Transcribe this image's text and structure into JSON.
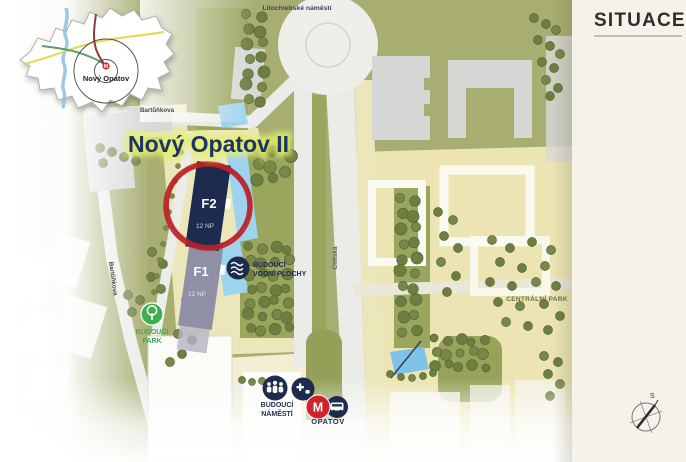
{
  "panel": {
    "title": "SITUACE"
  },
  "inset": {
    "place_label": "Nový Opatov",
    "metro_symbol": "M"
  },
  "map": {
    "project_title": "Nový Opatov II",
    "streets": {
      "litochlebske_namesti": "Litochlebské náměstí",
      "bartunkova_top": "Bartůňkova",
      "bartunkova_west": "Bartůňkova",
      "chilska": "Chilská"
    },
    "buildings": {
      "f2": {
        "label": "F2",
        "floors": "12 NP"
      },
      "f1": {
        "label": "F1",
        "floors": "12 NP"
      }
    },
    "poi": {
      "future_water": {
        "line1": "BUDOUCÍ",
        "line2": "VODNÍ PLOCHY"
      },
      "future_park": {
        "line1": "BUDOUCÍ",
        "line2": "PARK"
      },
      "future_square": {
        "line1": "BUDOUCÍ",
        "line2": "NÁMĚSTÍ"
      },
      "central_park": "CENTRÁLNÍ PARK",
      "metro_station": "OPATOV",
      "metro_symbol": "M"
    },
    "compass_north": "S"
  },
  "colors": {
    "navy": "#1d2b4e",
    "building_f1_gray": "#8f8fa5",
    "highlight_red": "#bb2227",
    "metro_red": "#d0222c",
    "park_green": "#3fae52",
    "water_blue": "#9ed3ee",
    "ground_olive": "#a8ae72",
    "ground_beige": "#ece6bb",
    "panel_cream": "#f5f2e9",
    "title_navy": "#1e3366",
    "title_glow": "#e3f06a"
  }
}
